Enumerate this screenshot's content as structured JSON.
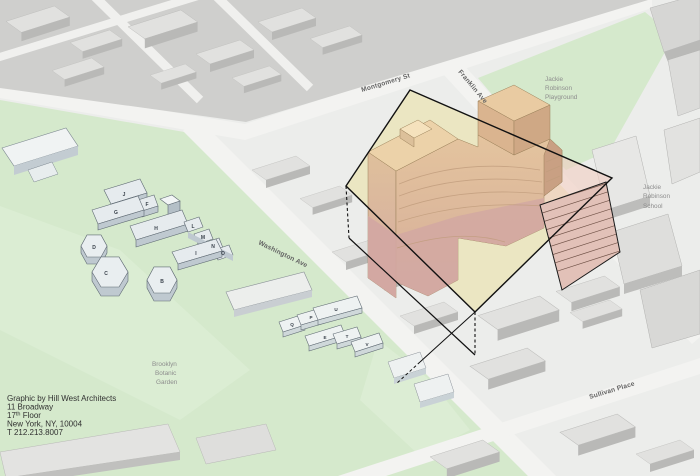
{
  "diagram": {
    "attribution": {
      "line1": "Graphic by Hill West Architects",
      "line2": "11 Broadway",
      "floor_num": "17",
      "floor_sup": "th",
      "floor_rest": " Floor",
      "line4": "New York, NY, 10004",
      "line5": "T 212.213.8007"
    },
    "streets": {
      "montgomery": "Montgomery St",
      "franklin": "Franklin Ave",
      "washington": "Washington Ave",
      "sullivan": "Sullivan Place"
    },
    "areas": {
      "playground": [
        "Jackie",
        "Robinson",
        "Playground"
      ],
      "school": [
        "Jackie",
        "Robinson",
        "School"
      ],
      "garden": [
        "Brooklyn",
        "Botanic",
        "Garden"
      ]
    },
    "building_letters": {
      "cluster": [
        "J",
        "F",
        "G",
        "H",
        "L",
        "M",
        "N",
        "O",
        "I",
        "D",
        "C",
        "B"
      ],
      "greenhouses": [
        "Q",
        "P",
        "U",
        "E",
        "T",
        "V"
      ]
    },
    "colors": {
      "garden_green": "#d5e9cc",
      "street_gray": "#f1f1ef",
      "context_gray": "#cfcfcd",
      "proposal_tan": "#e2c29d",
      "proposal_pink": "#d5aba5",
      "envelope_yellow": "#ebe5bc",
      "envelope_pink": "#f2cdc2",
      "outline_black": "#111111"
    }
  }
}
